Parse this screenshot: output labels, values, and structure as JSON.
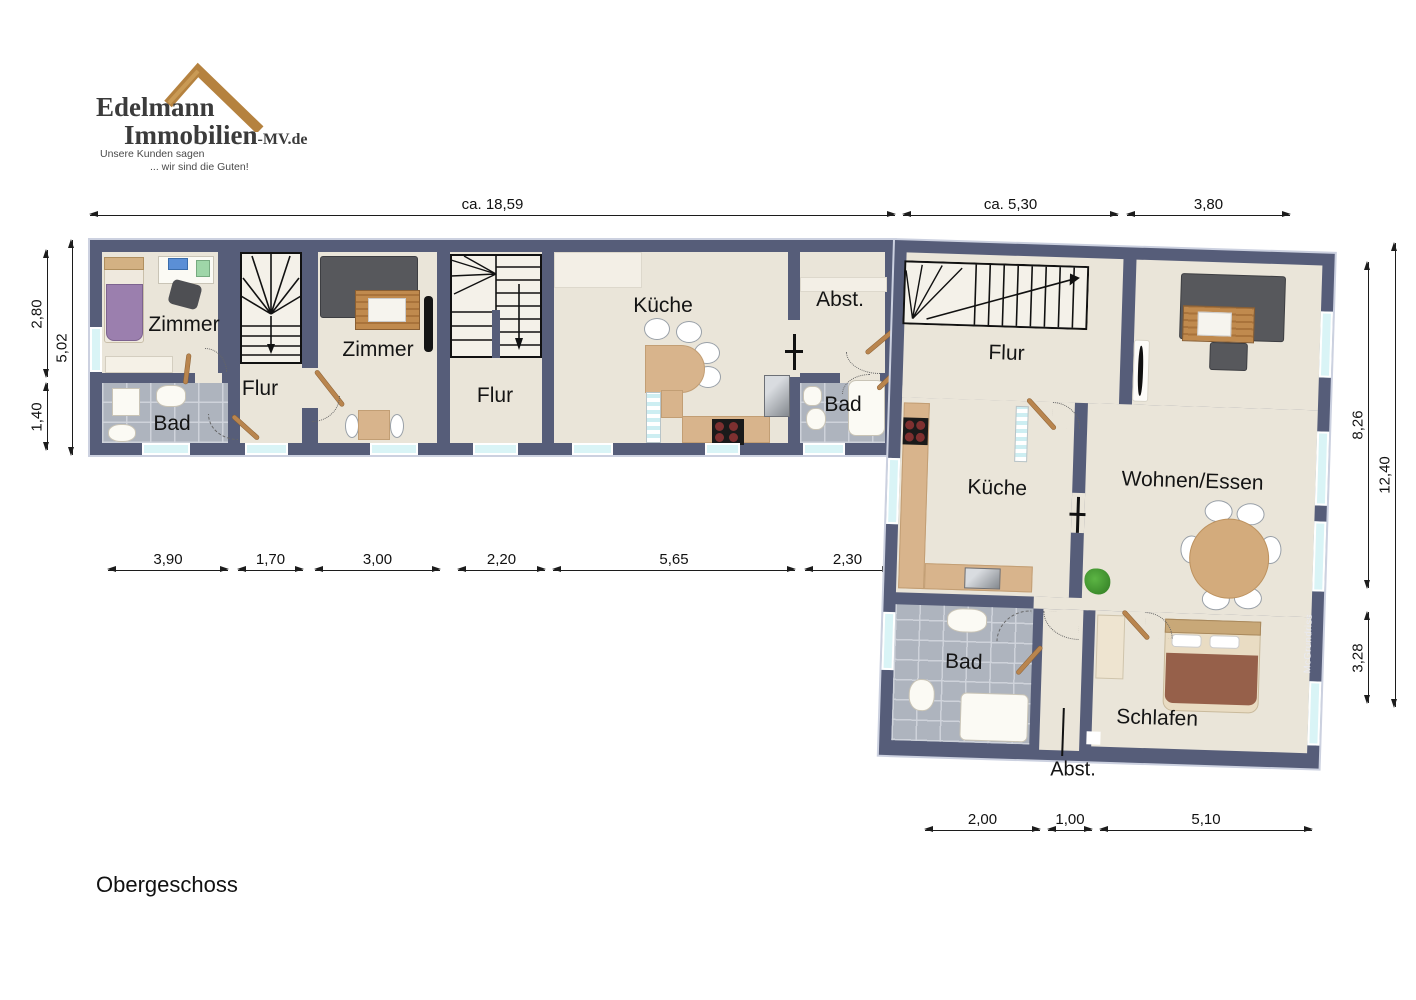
{
  "logo": {
    "name_line1": "Edelmann",
    "name_line2": "Immobilien",
    "name_suffix": "-MV.de",
    "tagline_1": "Unsere Kunden sagen",
    "tagline_2": "... wir sind die Guten!"
  },
  "floor_label": "Obergeschoss",
  "watermark": "McGrundriss",
  "dimensions": {
    "top": [
      {
        "label": "ca. 18,59"
      },
      {
        "label": "ca. 5,30"
      },
      {
        "label": "3,80"
      }
    ],
    "left_inner": [
      {
        "label": "2,80"
      },
      {
        "label": "1,40"
      }
    ],
    "left_outer": {
      "label": "5,02"
    },
    "right_inner": [
      {
        "label": "8,26"
      },
      {
        "label": "3,28"
      }
    ],
    "right_outer": {
      "label": "12,40"
    },
    "middle": [
      {
        "label": "3,90"
      },
      {
        "label": "1,70"
      },
      {
        "label": "3,00"
      },
      {
        "label": "2,20"
      },
      {
        "label": "5,65"
      },
      {
        "label": "2,30"
      }
    ],
    "bottom": [
      {
        "label": "2,00"
      },
      {
        "label": "1,00"
      },
      {
        "label": "5,10"
      }
    ]
  },
  "floorplan": {
    "left": [
      {
        "id": "zimmer1",
        "label": "Zimmer"
      },
      {
        "id": "flur1",
        "label": "Flur"
      },
      {
        "id": "bad1",
        "label": "Bad"
      },
      {
        "id": "zimmer2",
        "label": "Zimmer"
      },
      {
        "id": "flur2",
        "label": "Flur"
      },
      {
        "id": "kueche1",
        "label": "Küche"
      },
      {
        "id": "abst1",
        "label": "Abst."
      },
      {
        "id": "bad2",
        "label": "Bad"
      }
    ],
    "right": [
      {
        "id": "flur3",
        "label": "Flur"
      },
      {
        "id": "wohnen",
        "label": "Wohnen/Essen"
      },
      {
        "id": "kueche2",
        "label": "Küche"
      },
      {
        "id": "bad3",
        "label": "Bad"
      },
      {
        "id": "schlafen",
        "label": "Schlafen"
      },
      {
        "id": "abst2",
        "label": "Abst."
      }
    ]
  },
  "colors": {
    "wall": "#565d79",
    "floor": "#eae5d9",
    "tile": "#aeb4be",
    "window": "#d9f4f6",
    "counter": "#d8b48c",
    "wood": "#b9854e",
    "logo_brown": "#b5823f"
  }
}
